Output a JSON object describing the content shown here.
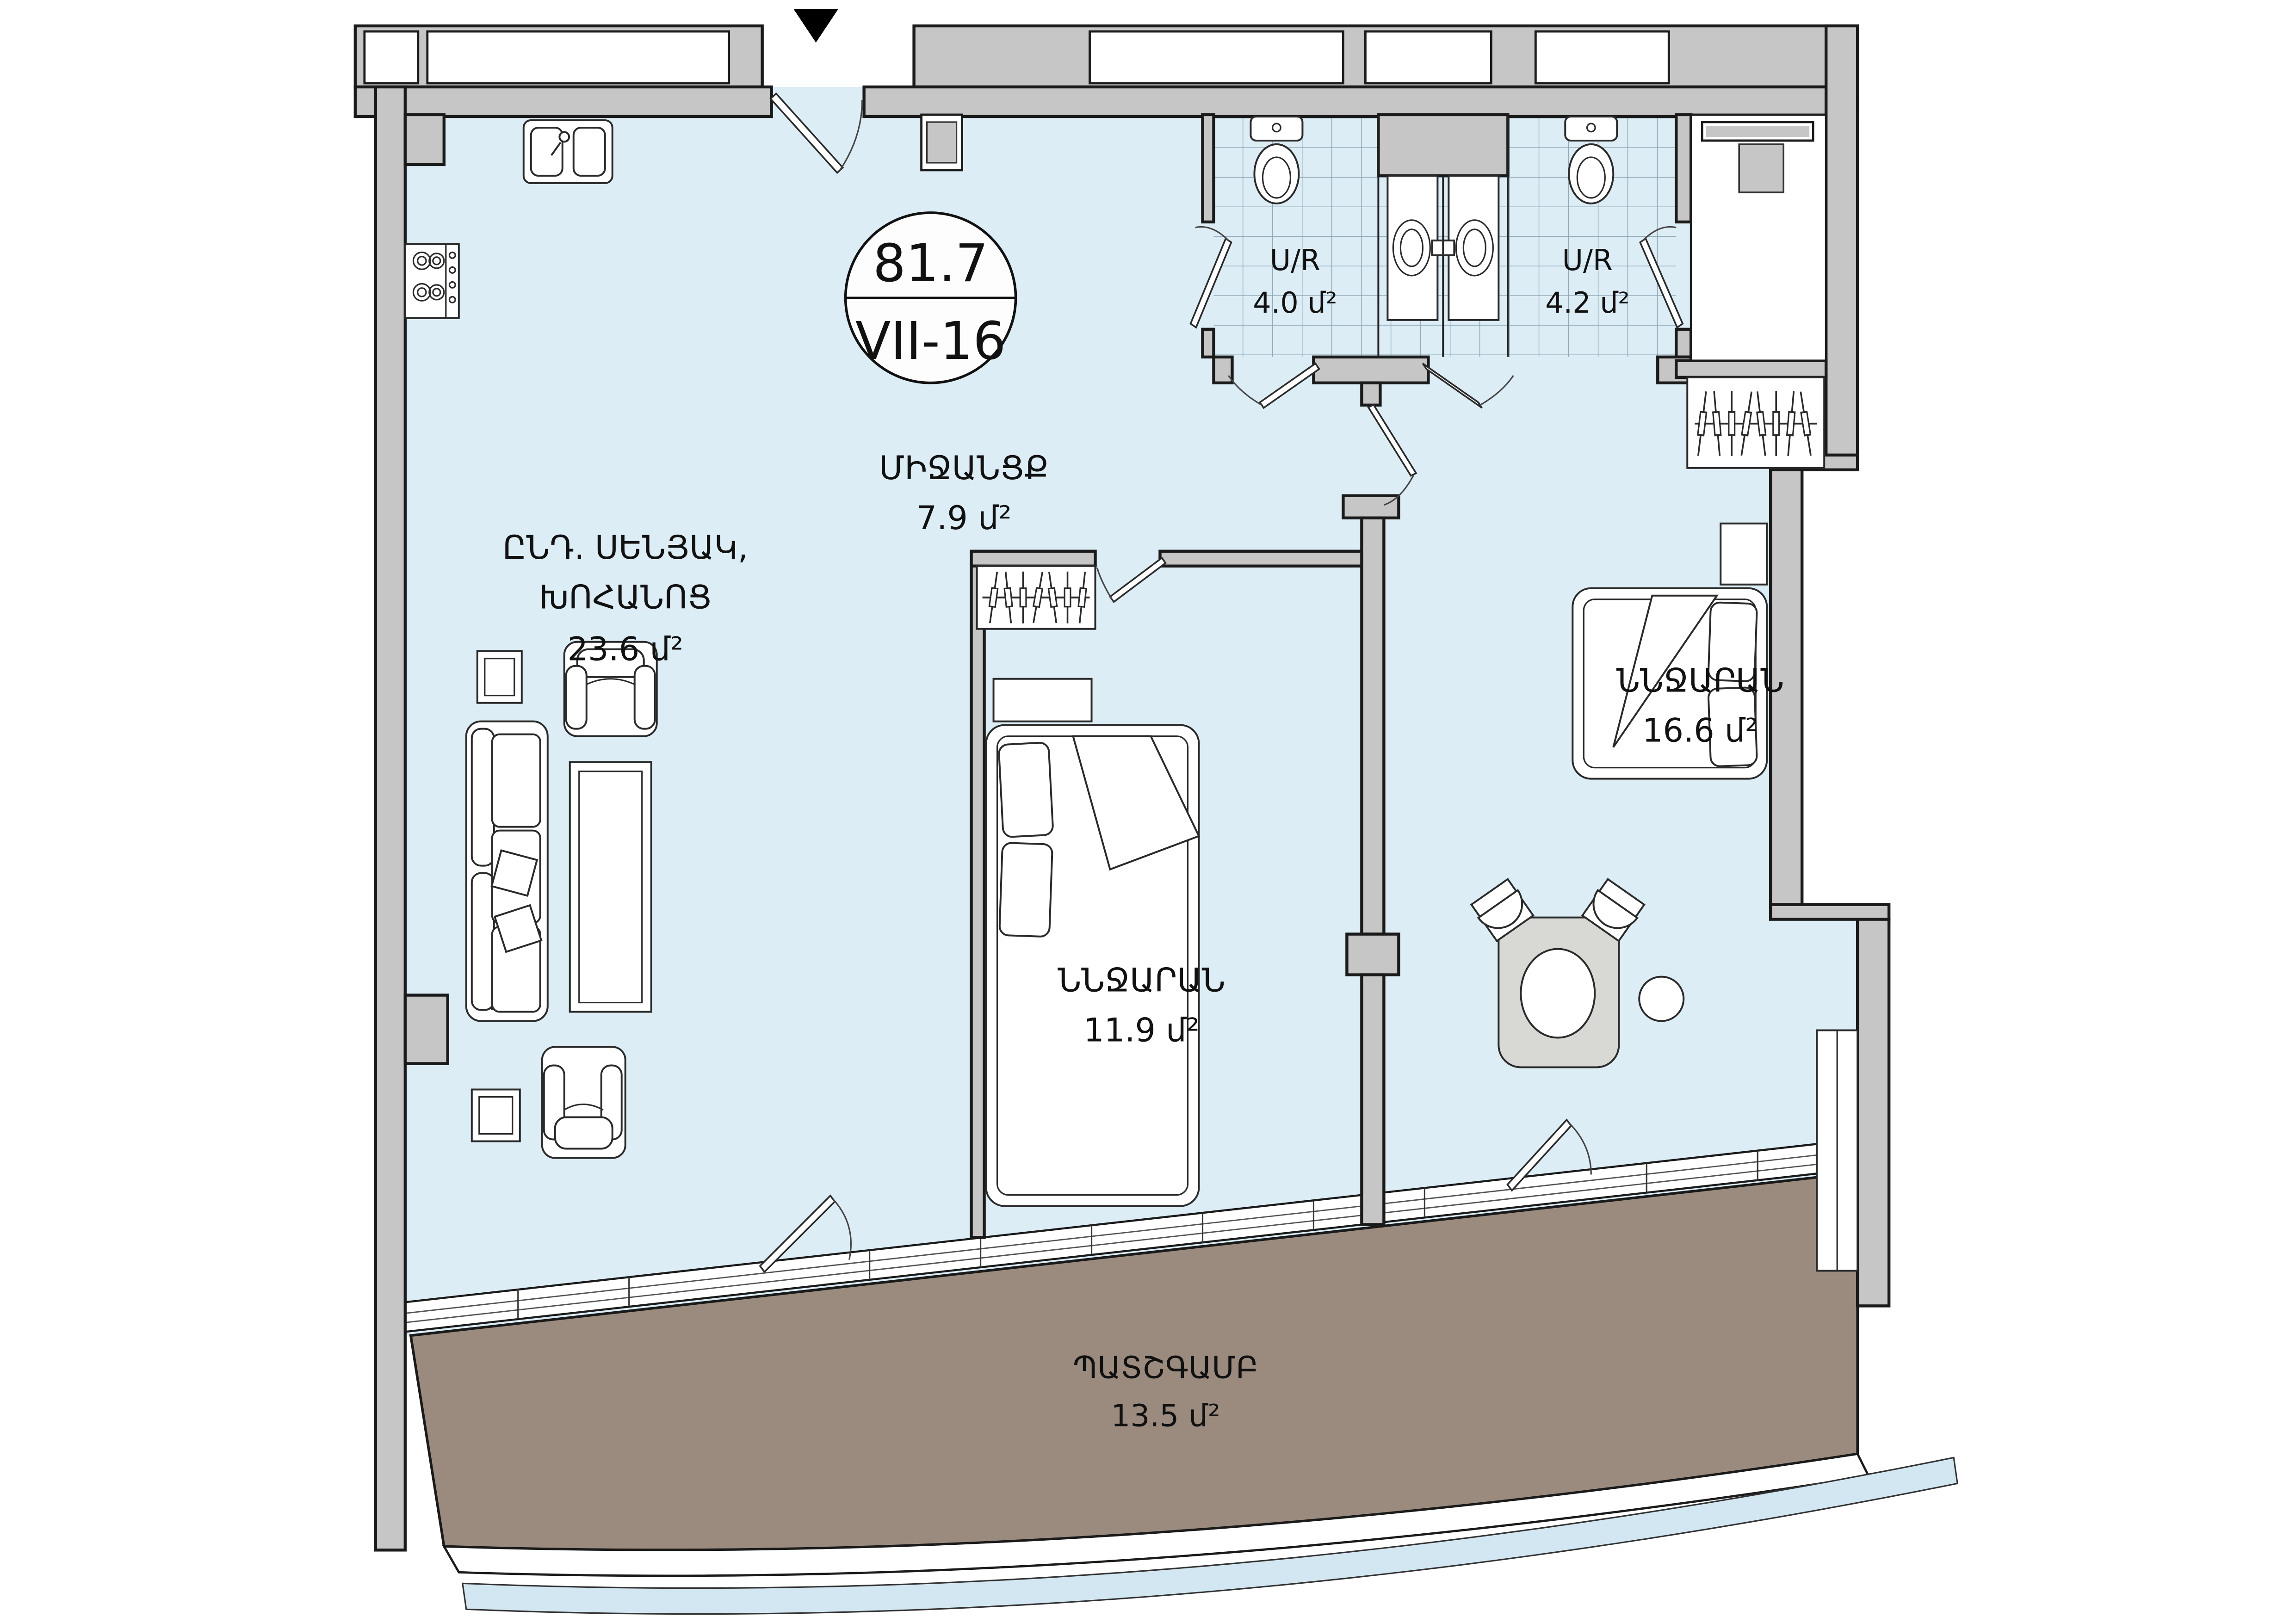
{
  "plan": {
    "marker": {
      "area_total": "81.7",
      "unit_code": "VII-16"
    },
    "rooms": {
      "living": {
        "name_line1": "ԸՆԴ. ՍԵՆՅԱԿ,",
        "name_line2": "ԽՈՀԱՆՈՑ",
        "area": "23.6 մ²"
      },
      "hallway": {
        "name": "ՄԻՋԱՆՑՔ",
        "area": "7.9 մ²"
      },
      "bathroom_1": {
        "name": "U/R",
        "area": "4.0 մ²"
      },
      "bathroom_2": {
        "name": "U/R",
        "area": "4.2 մ²"
      },
      "bedroom_1": {
        "name": "ՆՆՋԱՐԱՆ",
        "area": "11.9 մ²"
      },
      "bedroom_2": {
        "name": "ՆՆՋԱՐԱՆ",
        "area": "16.6 մ²"
      },
      "balcony": {
        "name": "ՊԱՏՇԳԱՄԲ",
        "area": "13.5 մ²"
      }
    },
    "colors": {
      "floor": "#ddedf6",
      "wall": "#c6c6c6",
      "balcony": "#9b8b7f",
      "outline": "#1a1a1a",
      "tile": "#7e98a6",
      "table": "#d8d8d5"
    }
  }
}
